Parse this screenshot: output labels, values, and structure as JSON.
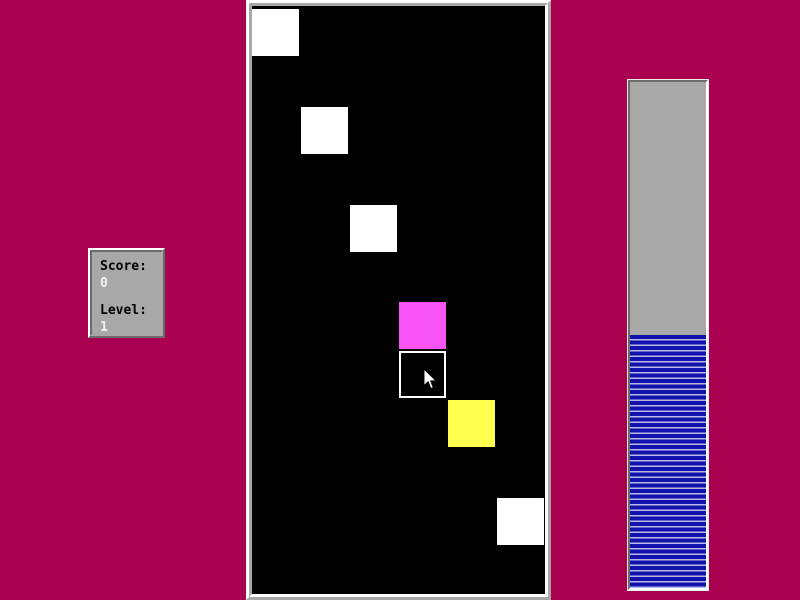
{
  "colors": {
    "background": "#aa0050",
    "panel_face": "#a8a8a8",
    "panel_shadow": "#6b6b6b",
    "panel_highlight": "#ffffff",
    "board_background": "#000000",
    "progress_track": "#a9a9a9",
    "progress_stripe_dark": "#1111ae",
    "progress_stripe_light": "#b9b9e2"
  },
  "score_panel": {
    "score_label": "Score:",
    "score_value": "0",
    "level_label": "Level:",
    "level_value": "1"
  },
  "board": {
    "square_size": 47,
    "squares": [
      {
        "x": 0,
        "y": 3,
        "color": "#ffffff",
        "kind": "tile"
      },
      {
        "x": 49,
        "y": 101,
        "color": "#ffffff",
        "kind": "tile"
      },
      {
        "x": 98,
        "y": 199,
        "color": "#ffffff",
        "kind": "tile"
      },
      {
        "x": 147,
        "y": 296,
        "color": "#f854f8",
        "kind": "tile"
      },
      {
        "x": 147,
        "y": 345,
        "color": "#000000",
        "kind": "outlined"
      },
      {
        "x": 196,
        "y": 394,
        "color": "#ffff50",
        "kind": "tile"
      },
      {
        "x": 245,
        "y": 492,
        "color": "#ffffff",
        "kind": "tile"
      }
    ]
  },
  "cursor": {
    "x": 423,
    "y": 368
  },
  "progress_bar": {
    "fill_percent": 50
  }
}
